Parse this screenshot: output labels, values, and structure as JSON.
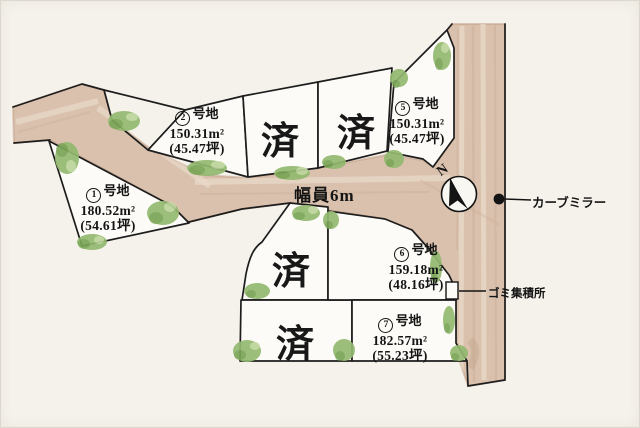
{
  "map": {
    "road_width_label": "幅員6m",
    "curve_mirror_label": "カーブミラー",
    "garbage_label": "ゴミ集積所",
    "north_label": "N",
    "sold_label": "済",
    "lots": [
      {
        "number": "1",
        "name": "号地",
        "area": "180.52m²",
        "tsubo": "(54.61坪)"
      },
      {
        "number": "2",
        "name": "号地",
        "area": "150.31m²",
        "tsubo": "(45.47坪)"
      },
      {
        "number": "5",
        "name": "号地",
        "area": "150.31m²",
        "tsubo": "(45.47坪)"
      },
      {
        "number": "6",
        "name": "号地",
        "area": "159.18m²",
        "tsubo": "(48.16坪)"
      },
      {
        "number": "7",
        "name": "号地",
        "area": "182.57m²",
        "tsubo": "(55.23坪)"
      }
    ],
    "sold_lot_count": 4,
    "colors": {
      "paper": "#f5f2eb",
      "road": "#d9c1ae",
      "road_edge": "#c2a186",
      "lot_fill": "#fcfbf7",
      "boundary": "#1d1d1d",
      "bush": "#93b970",
      "bush_dark": "#6f9c4c",
      "bush_light": "#c8dca6"
    }
  }
}
